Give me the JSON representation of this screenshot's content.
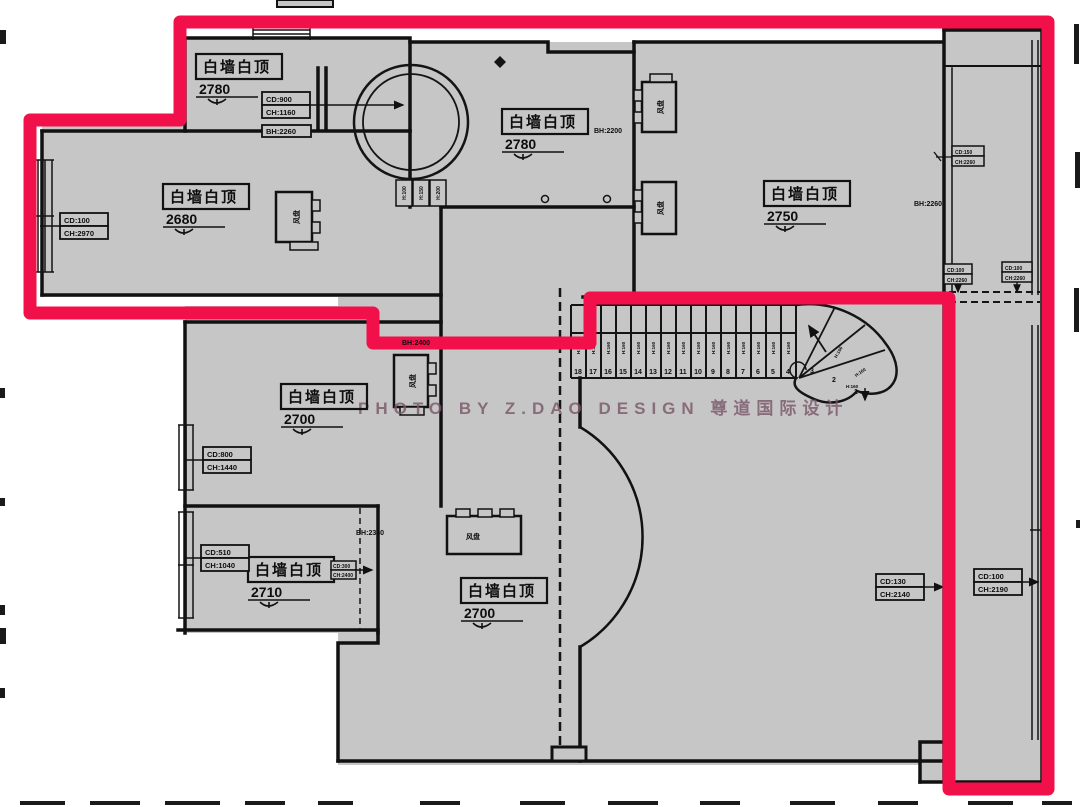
{
  "watermark": {
    "text": "PHOTO BY Z.DAO DESIGN 尊道国际设计"
  },
  "colors": {
    "highlight_red": "#F2104A",
    "plan_gray": "#C5C6C5",
    "wall_black": "#111111",
    "watermark_plum": "#7A5668"
  },
  "rooms": {
    "top_left": {
      "label": "白墙白顶",
      "height": "2780"
    },
    "top_center": {
      "label": "白墙白顶",
      "height": "2780"
    },
    "left": {
      "label": "白墙白顶",
      "height": "2680"
    },
    "right": {
      "label": "白墙白顶",
      "height": "2750"
    },
    "mid_left": {
      "label": "白墙白顶",
      "height": "2700"
    },
    "bottom_left": {
      "label": "白墙白顶",
      "height": "2710"
    },
    "bottom_center": {
      "label": "白墙白顶",
      "height": "2700"
    }
  },
  "dims": {
    "window_top_left": {
      "line1": "CD:900",
      "line2": "CH:1160"
    },
    "window_left": {
      "line1": "CD:100",
      "line2": "CH:2970"
    },
    "window_mid_left": {
      "line1": "CD:800",
      "line2": "CH:1440"
    },
    "window_bottom_left": {
      "line1": "CD:510",
      "line2": "CH:1040"
    },
    "window_right_inner": {
      "line1": "CD:130",
      "line2": "CH:2140"
    },
    "window_right_outer": {
      "line1": "CD:100",
      "line2": "CH:2190"
    },
    "corridor_top": {
      "line1": "CD:150",
      "line2": "CH:2260"
    },
    "curtain_left": {
      "line1": "CD:100",
      "line2": "CH:2260"
    },
    "curtain_right": {
      "line1": "CD:100",
      "line2": "CH:2260"
    },
    "room2710_arrow": {
      "line1": "CD:300",
      "line2": "CH:2400"
    }
  },
  "beams": {
    "top_left": "BH:2260",
    "top_center": "BH:2200",
    "corridor": "BH:2260",
    "bottom_left": "BH:2340",
    "mid": "BH:2400"
  },
  "equipment": {
    "fan_coil": "风盘"
  },
  "stairs": {
    "riser": "H:160",
    "steps": [
      "18",
      "17",
      "16",
      "15",
      "14",
      "13",
      "12",
      "11",
      "10",
      "9",
      "8",
      "7",
      "6",
      "5",
      "4",
      "3",
      "2",
      "1"
    ]
  },
  "dome_tags": [
    "H:100",
    "H:150",
    "H:200"
  ]
}
